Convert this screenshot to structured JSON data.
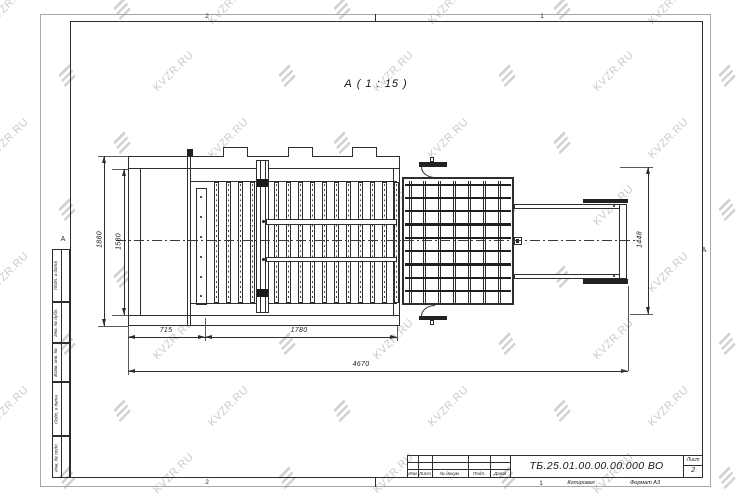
{
  "watermark": {
    "text": "KVZR.RU"
  },
  "view": {
    "label": "А ( 1 : 15 )"
  },
  "zones": {
    "top_left": "2",
    "top_right": "1",
    "bottom_left": "2",
    "bottom_right": "1",
    "side_left": "А",
    "side_right": "А"
  },
  "drawing": {
    "dims": {
      "outer_height": "1880",
      "inner_height": "1580",
      "front_section": "715",
      "grate_section": "1780",
      "total_length": "4670",
      "basket_height": "1448"
    },
    "grate_bar_count": 15,
    "plate_bolt_count": 6,
    "basket_grid": {
      "cols": 8,
      "rows": 10
    }
  },
  "side_fields": {
    "labels": [
      "Подп. и дата",
      "Инв. № дубл.",
      "Взам. инв. №",
      "Подп. и дата",
      "Инв. № подл."
    ]
  },
  "title_block": {
    "designation": "ТБ.25.01.00.00.00.000 ВО",
    "columns": [
      "Изм",
      "Лист",
      "№ докум.",
      "Подп.",
      "Дата"
    ],
    "sheet_label": "Лист",
    "sheet_number": "2",
    "footer": {
      "copied": "Копировал",
      "format": "Формат А3"
    }
  }
}
